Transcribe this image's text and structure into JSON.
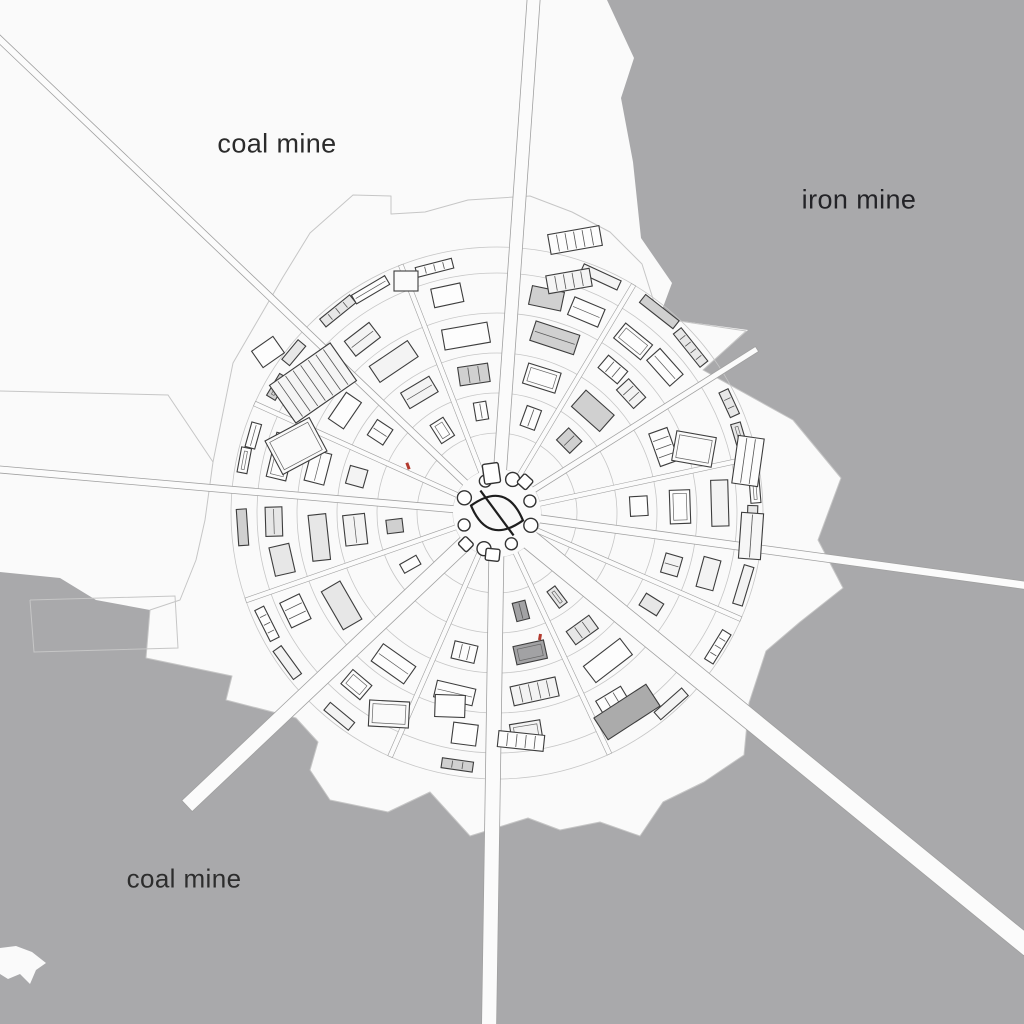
{
  "title": "radial mining city map",
  "labels": [
    {
      "id": "coal-mine-top",
      "text": "coal mine",
      "x": 277,
      "y": 144,
      "size": 27,
      "color": "#2b2b2b"
    },
    {
      "id": "iron-mine",
      "text": "iron mine",
      "x": 859,
      "y": 200,
      "size": 27,
      "color": "#232327"
    },
    {
      "id": "coal-mine-bottom",
      "text": "coal mine",
      "x": 184,
      "y": 879,
      "size": 26,
      "color": "#2d2d2d"
    }
  ],
  "colors": {
    "ground": "#fafafa",
    "terrain": "#a9a9ab",
    "road": "#fbfbfb",
    "roadEdge": "#a0a0a0",
    "faint": "#c6c6c6",
    "line": "#3d3d3d",
    "coreLine": "#1e1e1e",
    "accentRed": "#b33a2e"
  },
  "map": {
    "seed": 7,
    "center": {
      "x": 497,
      "y": 513
    },
    "terrain": {
      "gray": [
        [
          607,
          0
        ],
        [
          634,
          58
        ],
        [
          621,
          98
        ],
        [
          633,
          162
        ],
        [
          641,
          238
        ],
        [
          672,
          283
        ],
        [
          659,
          318
        ],
        [
          748,
          330
        ],
        [
          703,
          370
        ],
        [
          793,
          420
        ],
        [
          841,
          478
        ],
        [
          818,
          540
        ],
        [
          843,
          588
        ],
        [
          800,
          622
        ],
        [
          766,
          651
        ],
        [
          749,
          703
        ],
        [
          744,
          755
        ],
        [
          704,
          782
        ],
        [
          663,
          802
        ],
        [
          640,
          836
        ],
        [
          600,
          822
        ],
        [
          560,
          830
        ],
        [
          528,
          818
        ],
        [
          470,
          836
        ],
        [
          430,
          792
        ],
        [
          388,
          812
        ],
        [
          330,
          800
        ],
        [
          310,
          770
        ],
        [
          318,
          742
        ],
        [
          296,
          718
        ],
        [
          226,
          700
        ],
        [
          232,
          676
        ],
        [
          146,
          658
        ],
        [
          150,
          610
        ],
        [
          96,
          600
        ],
        [
          60,
          578
        ],
        [
          0,
          572
        ],
        [
          0,
          1024
        ],
        [
          1024,
          1024
        ],
        [
          1024,
          0
        ]
      ],
      "island": [
        [
          0,
          948
        ],
        [
          16,
          946
        ],
        [
          32,
          952
        ],
        [
          46,
          963
        ],
        [
          36,
          970
        ],
        [
          30,
          984
        ],
        [
          20,
          974
        ],
        [
          8,
          979
        ],
        [
          0,
          974
        ]
      ]
    },
    "city_limit": [
      [
        353,
        195
      ],
      [
        391,
        196
      ],
      [
        391,
        214
      ],
      [
        425,
        212
      ],
      [
        468,
        200
      ],
      [
        530,
        196
      ],
      [
        572,
        212
      ],
      [
        610,
        232
      ],
      [
        642,
        264
      ],
      [
        659,
        318
      ],
      [
        746,
        331
      ],
      [
        703,
        370
      ],
      [
        793,
        420
      ],
      [
        841,
        478
      ],
      [
        818,
        540
      ],
      [
        843,
        588
      ],
      [
        800,
        622
      ],
      [
        766,
        651
      ],
      [
        749,
        703
      ],
      [
        744,
        755
      ],
      [
        704,
        782
      ],
      [
        663,
        802
      ],
      [
        640,
        836
      ],
      [
        600,
        822
      ],
      [
        560,
        830
      ],
      [
        528,
        818
      ],
      [
        470,
        836
      ],
      [
        430,
        792
      ],
      [
        388,
        812
      ],
      [
        330,
        800
      ],
      [
        310,
        770
      ],
      [
        318,
        742
      ],
      [
        296,
        718
      ],
      [
        226,
        700
      ],
      [
        232,
        676
      ],
      [
        146,
        658
      ],
      [
        150,
        610
      ],
      [
        180,
        600
      ],
      [
        196,
        560
      ],
      [
        205,
        520
      ],
      [
        213,
        462
      ],
      [
        233,
        363
      ],
      [
        283,
        277
      ],
      [
        310,
        233
      ]
    ],
    "field_lines": [
      [
        [
          0,
          391
        ],
        [
          168,
          395
        ],
        [
          213,
          462
        ]
      ],
      [
        [
          30,
          600
        ],
        [
          175,
          596
        ],
        [
          178,
          648
        ],
        [
          34,
          652
        ],
        [
          30,
          600
        ]
      ]
    ],
    "rings": [
      44,
      80,
      120,
      160,
      200,
      240,
      266
    ],
    "roads": [
      {
        "name": "nw-road",
        "x": -6,
        "y": 34,
        "w": 7
      },
      {
        "name": "n-road",
        "x": 534,
        "y": -6,
        "w": 13
      },
      {
        "name": "ne-road",
        "x": 757,
        "y": 349,
        "w": 6
      },
      {
        "name": "e-road",
        "x": 1030,
        "y": 586,
        "w": 8
      },
      {
        "name": "se-road",
        "x": 1030,
        "y": 948,
        "w": 20
      },
      {
        "name": "s-road",
        "x": 489,
        "y": 1030,
        "w": 15
      },
      {
        "name": "sw-road",
        "x": 187,
        "y": 806,
        "w": 15
      },
      {
        "name": "w-road",
        "x": -6,
        "y": 469,
        "w": 7
      }
    ],
    "spokes": [
      {
        "a": 7.8,
        "hw": 8
      },
      {
        "a": 23.5,
        "hw": 6
      },
      {
        "a": 39.2,
        "hw": 14
      },
      {
        "a": 65,
        "hw": 6
      },
      {
        "a": 90.9,
        "hw": 11
      },
      {
        "a": 113.7,
        "hw": 6
      },
      {
        "a": 136.6,
        "hw": 11
      },
      {
        "a": 160.8,
        "hw": 6
      },
      {
        "a": 185,
        "hw": 7.5
      },
      {
        "a": 204.3,
        "hw": 6
      },
      {
        "a": 223.6,
        "hw": 7.5
      },
      {
        "a": 248.8,
        "hw": 6
      },
      {
        "a": 274.1,
        "hw": 10.5
      },
      {
        "a": 300.9,
        "hw": 6
      },
      {
        "a": 327.8,
        "hw": 7
      },
      {
        "a": 347.8,
        "hw": 6
      }
    ],
    "street_width": 5,
    "street_r0": 40,
    "street_r1": 266,
    "bands": [
      [
        48,
        78
      ],
      [
        86,
        118
      ],
      [
        126,
        158
      ],
      [
        166,
        198
      ],
      [
        206,
        238
      ],
      [
        246,
        266
      ]
    ],
    "skip": [
      0.04,
      0.05,
      0.07,
      0.12,
      0.2,
      0.42
    ],
    "outliers": [
      {
        "x": 313,
        "y": 383,
        "w": 74,
        "h": 46,
        "rot": -35,
        "fill": "#f5f5f5",
        "style": "striped"
      },
      {
        "x": 268,
        "y": 352,
        "w": 26,
        "h": 20,
        "rot": -35,
        "fill": "#fdfdfd",
        "style": "plain"
      },
      {
        "x": 296,
        "y": 446,
        "w": 50,
        "h": 38,
        "rot": -28,
        "fill": "#fafafa",
        "style": "inner"
      },
      {
        "x": 575,
        "y": 240,
        "w": 52,
        "h": 20,
        "rot": -10,
        "fill": "#fdfdfd",
        "style": "striped"
      },
      {
        "x": 569,
        "y": 281,
        "w": 44,
        "h": 18,
        "rot": -10,
        "fill": "#f4f4f4",
        "style": "striped"
      },
      {
        "x": 406,
        "y": 281,
        "w": 24,
        "h": 20,
        "rot": 0,
        "fill": "#fbfbfb",
        "style": "plain"
      },
      {
        "x": 748,
        "y": 461,
        "w": 26,
        "h": 48,
        "rot": 8,
        "fill": "#fdfdfd",
        "style": "striped"
      },
      {
        "x": 751,
        "y": 536,
        "w": 22,
        "h": 46,
        "rot": 4,
        "fill": "#f6f6f6",
        "style": "striped"
      },
      {
        "x": 694,
        "y": 449,
        "w": 40,
        "h": 30,
        "rot": 10,
        "fill": "#fbfbfb",
        "style": "inner"
      },
      {
        "x": 627,
        "y": 712,
        "w": 62,
        "h": 26,
        "rot": -33,
        "fill": "#ababab",
        "style": "plain"
      },
      {
        "x": 521,
        "y": 741,
        "w": 46,
        "h": 16,
        "rot": 6,
        "fill": "#fdfdfd",
        "style": "striped"
      },
      {
        "x": 389,
        "y": 714,
        "w": 40,
        "h": 26,
        "rot": 3,
        "fill": "#fafafa",
        "style": "inner"
      },
      {
        "x": 450,
        "y": 706,
        "w": 30,
        "h": 22,
        "rot": 2,
        "fill": "#fdfdfd",
        "style": "plain"
      }
    ],
    "core": {
      "plaza_r": 44,
      "circles": [
        {
          "a": 20,
          "r": 36,
          "s": 7
        },
        {
          "a": 65,
          "r": 34,
          "s": 6
        },
        {
          "a": 110,
          "r": 38,
          "s": 7
        },
        {
          "a": 160,
          "r": 35,
          "s": 6
        },
        {
          "a": 205,
          "r": 36,
          "s": 7
        },
        {
          "a": 250,
          "r": 34,
          "s": 6
        },
        {
          "a": 295,
          "r": 37,
          "s": 7
        },
        {
          "a": 340,
          "r": 35,
          "s": 6
        }
      ],
      "rects": [
        {
          "a": 262,
          "r": 40,
          "w": 16,
          "h": 20
        },
        {
          "a": 312,
          "r": 42,
          "w": 12,
          "h": 12
        },
        {
          "a": 96,
          "r": 42,
          "w": 14,
          "h": 12
        },
        {
          "a": 135,
          "r": 44,
          "w": 12,
          "h": 11
        }
      ],
      "emblem": {
        "rx": 27,
        "hh": 17,
        "rot": 16
      }
    },
    "accents": [
      {
        "x": 408,
        "y": 466,
        "w": 3,
        "h": 7,
        "rot": -20
      },
      {
        "x": 540,
        "y": 637,
        "w": 3,
        "h": 6,
        "rot": 10
      }
    ]
  }
}
